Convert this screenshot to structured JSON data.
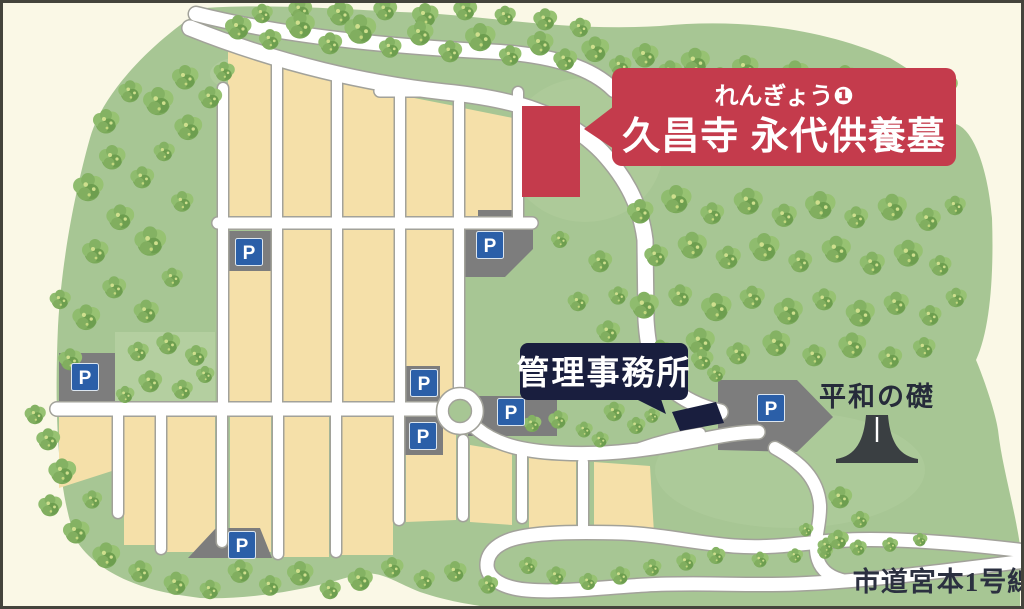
{
  "map": {
    "title_banner": {
      "subtitle": "れんぎょう❶",
      "title": "久昌寺 永代供養墓"
    },
    "labels": {
      "office": "管理事務所",
      "peace_monument": "平和の礎",
      "city_road": "市道宮本1号線",
      "parking": "P"
    },
    "colors": {
      "background_cream": "#faf8e6",
      "grounds_green": "#a7c694",
      "light_green": "#b4cfa0",
      "plot_beige": "#f5e0a9",
      "road_white": "#ffffff",
      "road_casing": "#a2a29a",
      "parking_gray": "#7d7d7d",
      "parking_sign_blue": "#2b5fa8",
      "banner_red": "#c43b4c",
      "office_navy": "#191e3e",
      "monument_gray": "#3a3f42",
      "frame_dark": "#44443c"
    }
  }
}
